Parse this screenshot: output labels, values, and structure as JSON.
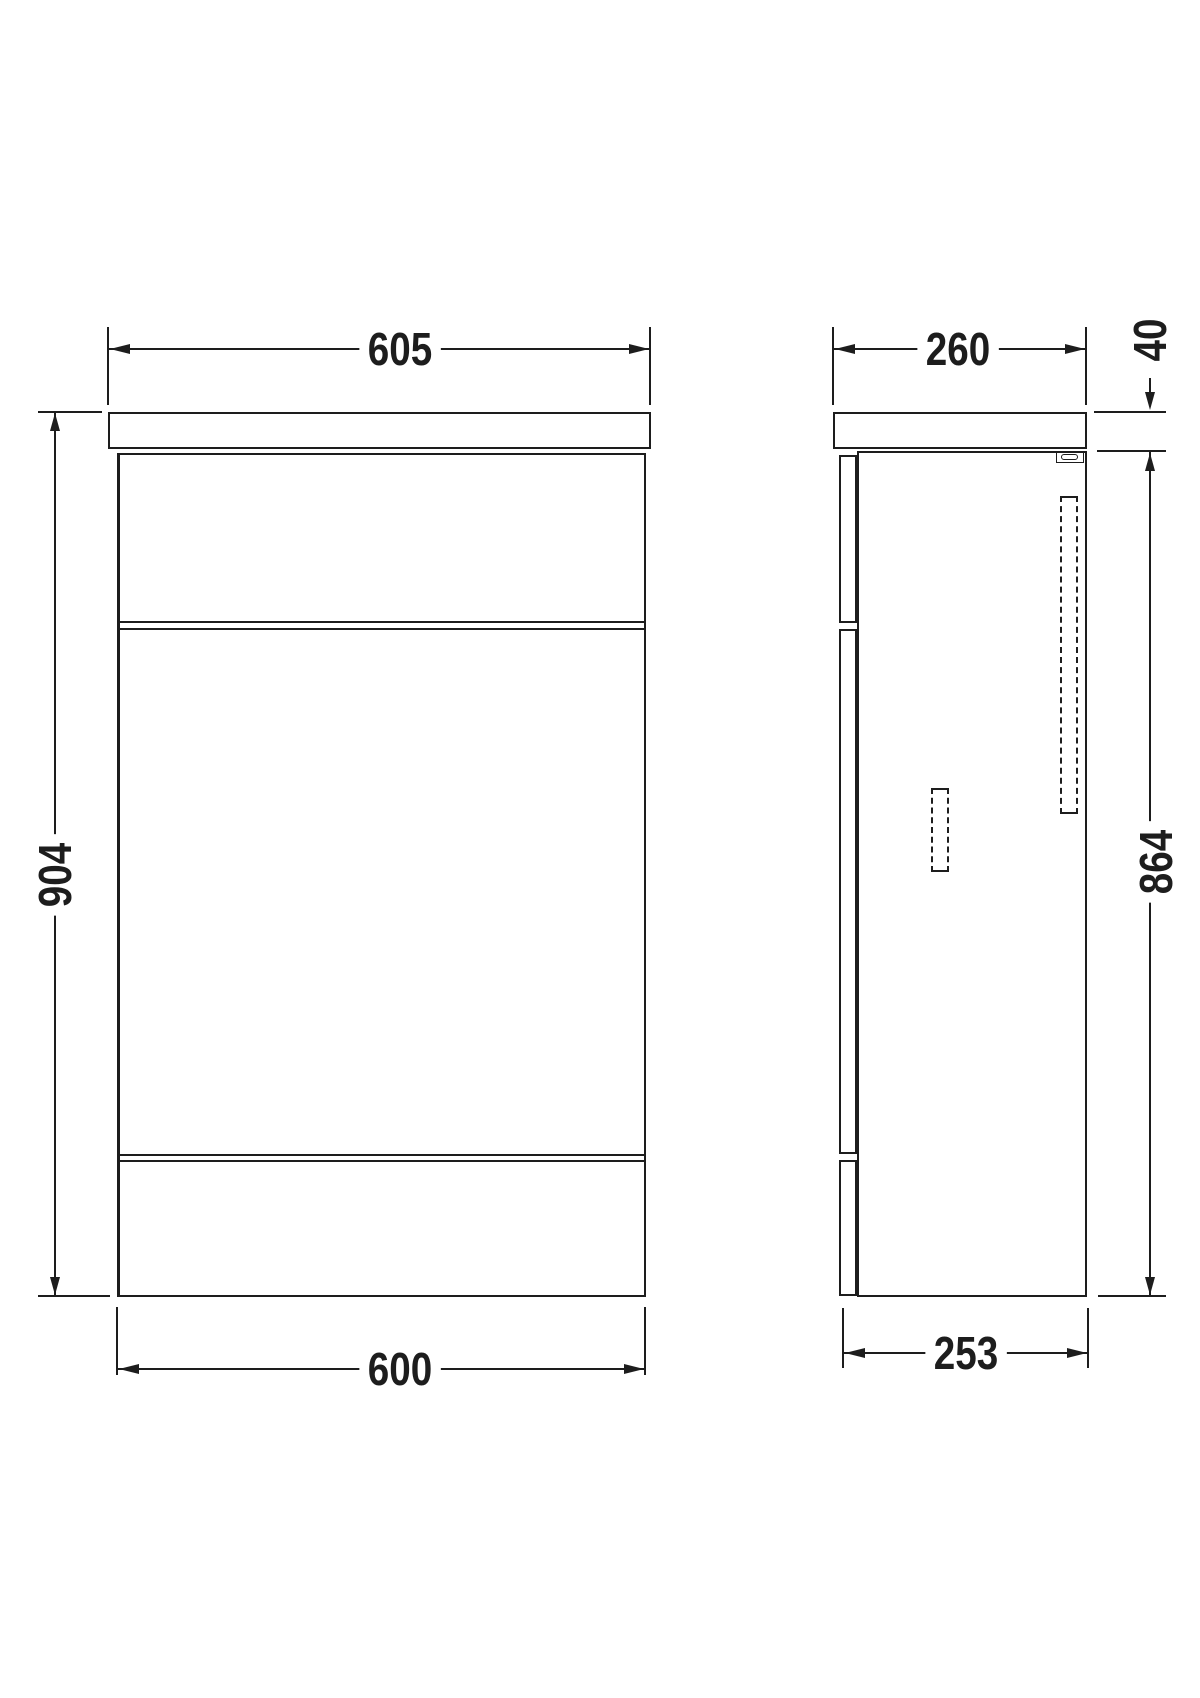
{
  "drawing_type": "technical-dimension-drawing",
  "colors": {
    "ink": "#1d1d1d",
    "background": "#ffffff"
  },
  "front_view": {
    "width_top_label": "605",
    "width_bottom_label": "600",
    "height_label": "904"
  },
  "side_view": {
    "depth_top_label": "260",
    "depth_bottom_label": "253",
    "height_label": "864",
    "worktop_thickness_label": "40"
  }
}
